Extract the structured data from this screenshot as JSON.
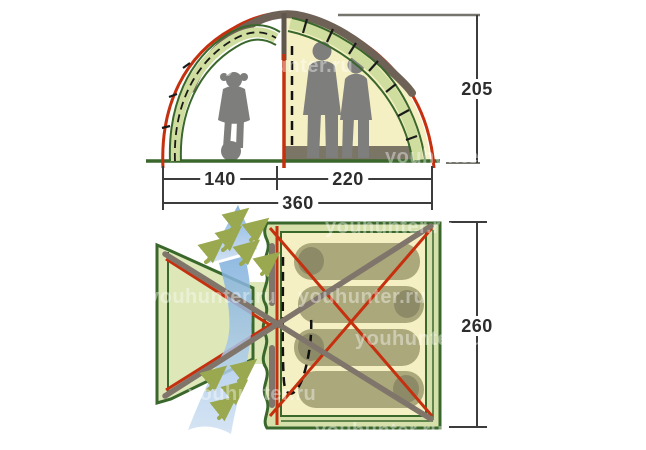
{
  "diagram_title": "tent-specification-diagram",
  "views": {
    "elevation": {
      "name": "front-elevation",
      "dimensions": {
        "height": "205",
        "vestibule_width": "140",
        "inner_tent_width": "220",
        "total_width": "360"
      }
    },
    "plan": {
      "name": "floor-plan",
      "dimensions": {
        "depth": "260"
      },
      "sleeping_places": 4
    }
  },
  "watermark": {
    "text": "youhunter.ru",
    "positions": [
      {
        "x": 225,
        "y": 55
      },
      {
        "x": 385,
        "y": 146
      },
      {
        "x": 325,
        "y": 216
      },
      {
        "x": 148,
        "y": 286
      },
      {
        "x": 298,
        "y": 286
      },
      {
        "x": 355,
        "y": 328
      },
      {
        "x": 188,
        "y": 383
      },
      {
        "x": 315,
        "y": 420
      }
    ]
  },
  "colors": {
    "frame_red": "#c5300f",
    "frame_green_dark": "#3a672c",
    "fly_green_light": "#cfdd9e",
    "inner_tent_yellow": "#f5f0c3",
    "pole_gray": "#80756b",
    "floor_gray": "#7b7566",
    "silhouette_gray": "#7e7e7c",
    "sleeping_bag_olive": "#aba87c",
    "airflow_blue": "#8ab3de",
    "vent_green": "#9aa94f",
    "dimension_text": "#2d2d2d"
  }
}
